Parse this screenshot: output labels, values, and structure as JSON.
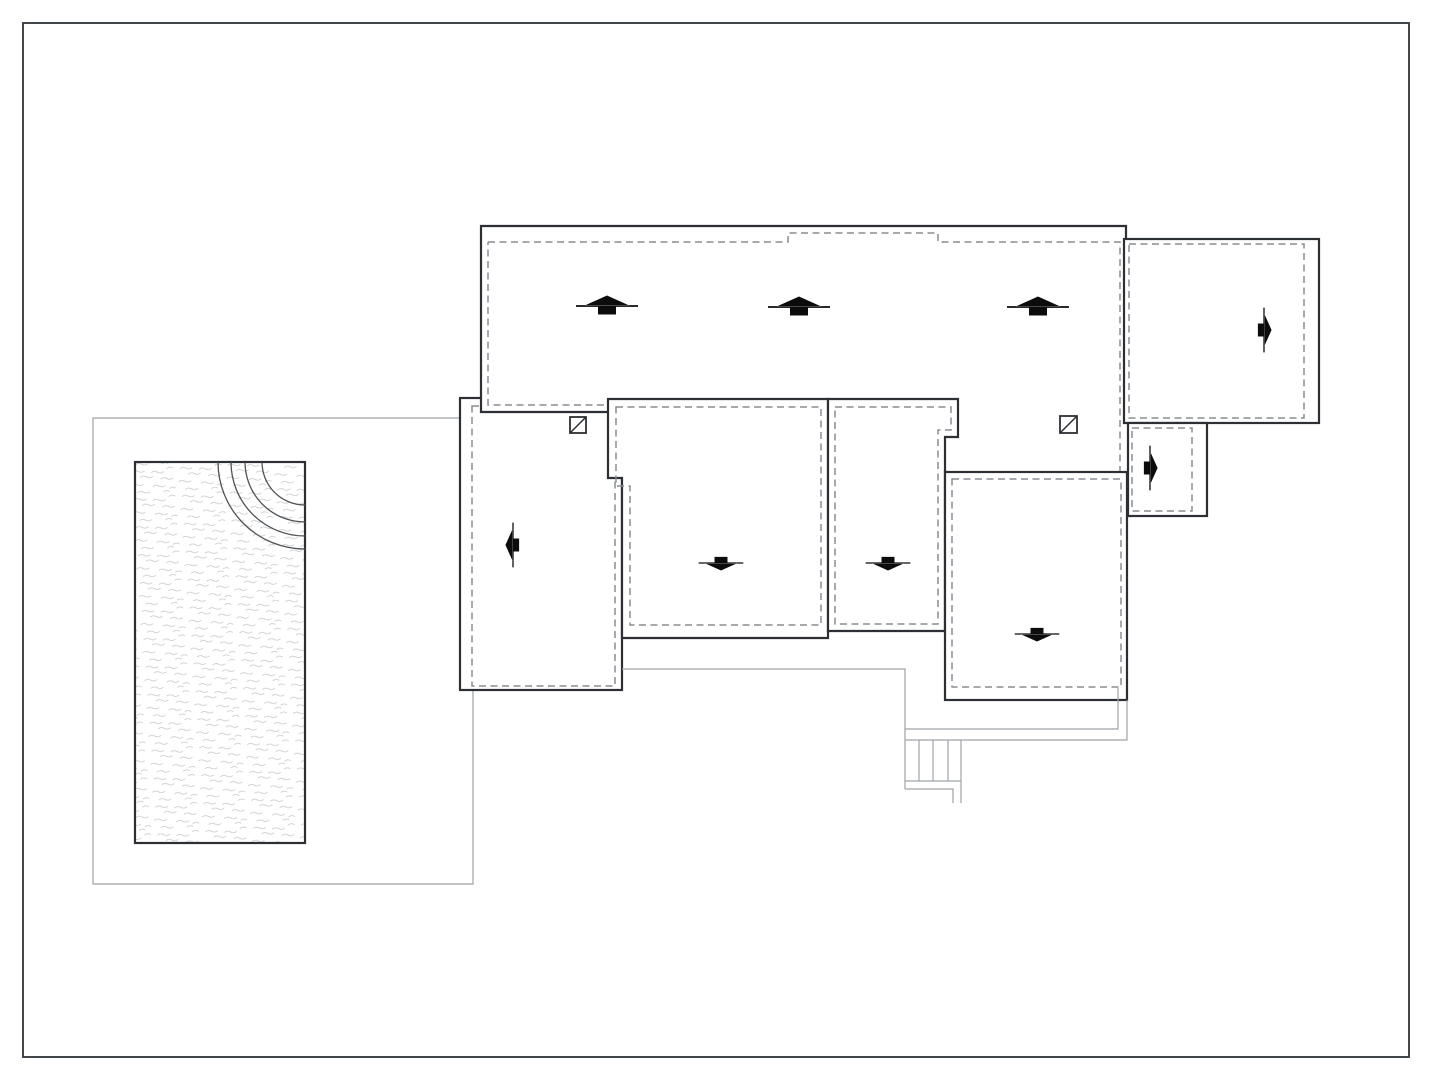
{
  "meta": {
    "width": 1432,
    "height": 1080,
    "background": "#ffffff",
    "drawing_type": "architectural roof and site plan with swimming pool, slope arrows, roof drains and exterior stair"
  },
  "colors": {
    "border": "#43474c",
    "wall": "#2c2f33",
    "dash": "#8a8d90",
    "thin": "#9fa4a8",
    "arc": "#4e5256",
    "arrow": "#0c0c0c",
    "water": "#c4c8cb"
  },
  "arrow_shape": {
    "d": "M-31,-0.9 L31,-0.9 L31,0.9 L-31,0.9 Z M-22,-0.6 L22,-0.6 L0,-10.5 Z M-9,-0.5 L9,-0.5 L9,8.5 L-9,8.5 Z",
    "rotation": {
      "up": 0,
      "right": 90,
      "down": 180,
      "left": 270
    }
  },
  "water_pattern": {
    "tile_w": 48,
    "tile_h": 28,
    "rotate": -4,
    "strokes": [
      "M3 4 q3 -2 6 0 t6 0",
      "M22 6 q3 -2 6 0 t6 0",
      "M38 3 q3 -2 6 0",
      "M11 10 q3 -2 6 0 t6 0",
      "M31 13 q3 -2 6 0 t6 0",
      "M1 17 q3 -2 6 0 t6 0",
      "M23 20 q3 -2 6 0 t6 0",
      "M39 23 q3 -2 6 0",
      "M7 25 q3 -2 6 0 t6 0",
      "M33 26 q3 -2 6 0"
    ]
  },
  "plan": {
    "elements": [
      {
        "name": "site-border",
        "type": "rect",
        "x": 23,
        "y": 23,
        "w": 1386,
        "h": 1034,
        "cls": "site-border"
      },
      {
        "name": "pool-terrace-outline",
        "type": "polyline",
        "pts": "460,418 93,418 93,884 473,884 473,689",
        "cls": "thin"
      },
      {
        "name": "pool-basin",
        "type": "rect",
        "x": 135,
        "y": 462,
        "w": 170,
        "h": 381,
        "cls": "pool"
      },
      {
        "name": "pool-step-arc",
        "type": "path",
        "d": "M 262 462 A 43 43 0 0 0 305 505",
        "cls": "arc"
      },
      {
        "name": "pool-step-arc",
        "type": "path",
        "d": "M 245 462 A 60 60 0 0 0 305 522",
        "cls": "arc"
      },
      {
        "name": "pool-step-arc",
        "type": "path",
        "d": "M 231 462 A 74 74 0 0 0 305 536",
        "cls": "arc"
      },
      {
        "name": "pool-step-arc",
        "type": "path",
        "d": "M 218 462 A 87 87 0 0 0 305 549",
        "cls": "arc"
      },
      {
        "name": "west-wing-roof",
        "type": "rect",
        "x": 460,
        "y": 398,
        "w": 162,
        "h": 292,
        "cls": "wall"
      },
      {
        "name": "west-wing-roof-inset",
        "type": "rect",
        "x": 472,
        "y": 406,
        "w": 143,
        "h": 280,
        "cls": "dash"
      },
      {
        "name": "main-roof-fill",
        "type": "rect",
        "x": 481,
        "y": 226,
        "w": 645,
        "h": 246,
        "cls": "fill-only"
      },
      {
        "name": "main-roof-outline",
        "type": "polyline",
        "pts": "608,412 481,412 481,226 1126,226 1126,422",
        "cls": "wall-line"
      },
      {
        "name": "main-roof-inset-west",
        "type": "polyline",
        "pts": "604,405 488,405 488,242",
        "cls": "dash"
      },
      {
        "name": "main-roof-inset-north",
        "type": "polyline",
        "pts": "488,242 788,242 788,233 938,233 938,242 1120,242 1120,471",
        "cls": "dash"
      },
      {
        "name": "east-wing-roof",
        "type": "rect",
        "x": 1124,
        "y": 239,
        "w": 195,
        "h": 184,
        "cls": "wall"
      },
      {
        "name": "east-wing-roof-inset",
        "type": "rect",
        "x": 1129,
        "y": 244,
        "w": 175,
        "h": 174,
        "cls": "dash"
      },
      {
        "name": "entry-canopy-roof",
        "type": "rect",
        "x": 1128,
        "y": 423,
        "w": 79,
        "h": 93,
        "cls": "wall"
      },
      {
        "name": "entry-canopy-inset",
        "type": "rect",
        "x": 1132,
        "y": 428,
        "w": 60,
        "h": 83,
        "cls": "dash"
      },
      {
        "name": "center-left-roof",
        "type": "polygon",
        "pts": "608,399 828,399 828,638 622,638 622,478 608,478",
        "cls": "wall"
      },
      {
        "name": "center-left-roof-inset",
        "type": "polygon",
        "pts": "616,407 821,407 821,625 630,625 630,486 616,486",
        "cls": "dash"
      },
      {
        "name": "center-right-roof",
        "type": "polygon",
        "pts": "828,399 958,399 958,437 945,437 945,631 828,631",
        "cls": "wall"
      },
      {
        "name": "center-right-roof-inset",
        "type": "polygon",
        "pts": "835,407 951,407 951,430 938,430 938,624 835,624",
        "cls": "dash"
      },
      {
        "name": "south-east-roof",
        "type": "rect",
        "x": 945,
        "y": 472,
        "w": 182,
        "h": 228,
        "cls": "wall"
      },
      {
        "name": "south-east-roof-inset",
        "type": "rect",
        "x": 952,
        "y": 479,
        "w": 169,
        "h": 208,
        "cls": "dash"
      },
      {
        "name": "terrace-walkway-edge",
        "type": "polyline",
        "pts": "622,669 905,669 905,789",
        "cls": "thin"
      },
      {
        "name": "walkway-inner-edge",
        "type": "polyline",
        "pts": "1118,688 1118,729 905,729",
        "cls": "thin"
      },
      {
        "name": "walkway-outer-edge",
        "type": "polyline",
        "pts": "1127,700 1127,740 905,740",
        "cls": "thin"
      },
      {
        "name": "stair-tread",
        "type": "line",
        "x1": 919,
        "y1": 740,
        "x2": 919,
        "y2": 781,
        "cls": "thin"
      },
      {
        "name": "stair-tread",
        "type": "line",
        "x1": 933,
        "y1": 740,
        "x2": 933,
        "y2": 781,
        "cls": "thin"
      },
      {
        "name": "stair-tread",
        "type": "line",
        "x1": 948,
        "y1": 740,
        "x2": 948,
        "y2": 781,
        "cls": "thin"
      },
      {
        "name": "stair-side-rail",
        "type": "line",
        "x1": 961,
        "y1": 740,
        "x2": 961,
        "y2": 803,
        "cls": "thin"
      },
      {
        "name": "stair-base",
        "type": "line",
        "x1": 905,
        "y1": 781,
        "x2": 961,
        "y2": 781,
        "cls": "thin"
      },
      {
        "name": "stair-lower-landing",
        "type": "polyline",
        "pts": "905,789 953,789 953,803",
        "cls": "thin"
      },
      {
        "name": "roof-drain-icon",
        "type": "drain",
        "x": 570,
        "y": 417,
        "s": 16
      },
      {
        "name": "roof-drain-icon",
        "type": "drain",
        "x": 1060,
        "y": 416,
        "s": 17
      },
      {
        "name": "slope-arrow-up-icon",
        "type": "arrow",
        "cx": 607,
        "cy": 306,
        "dir": "up",
        "s": 1
      },
      {
        "name": "slope-arrow-up-icon",
        "type": "arrow",
        "cx": 799,
        "cy": 307,
        "dir": "up",
        "s": 1
      },
      {
        "name": "slope-arrow-up-icon",
        "type": "arrow",
        "cx": 1038,
        "cy": 307,
        "dir": "up",
        "s": 1
      },
      {
        "name": "slope-arrow-right-icon",
        "type": "arrow",
        "cx": 1264,
        "cy": 330,
        "dir": "right",
        "s": 0.72
      },
      {
        "name": "slope-arrow-right-icon",
        "type": "arrow",
        "cx": 1150,
        "cy": 468,
        "dir": "right",
        "s": 0.72
      },
      {
        "name": "slope-arrow-left-icon",
        "type": "arrow",
        "cx": 513,
        "cy": 545,
        "dir": "left",
        "s": 0.72
      },
      {
        "name": "slope-arrow-down-icon",
        "type": "arrow",
        "cx": 721,
        "cy": 563,
        "dir": "down",
        "s": 0.72
      },
      {
        "name": "slope-arrow-down-icon",
        "type": "arrow",
        "cx": 888,
        "cy": 563,
        "dir": "down",
        "s": 0.72
      },
      {
        "name": "slope-arrow-down-icon",
        "type": "arrow",
        "cx": 1037,
        "cy": 634,
        "dir": "down",
        "s": 0.72
      }
    ]
  }
}
